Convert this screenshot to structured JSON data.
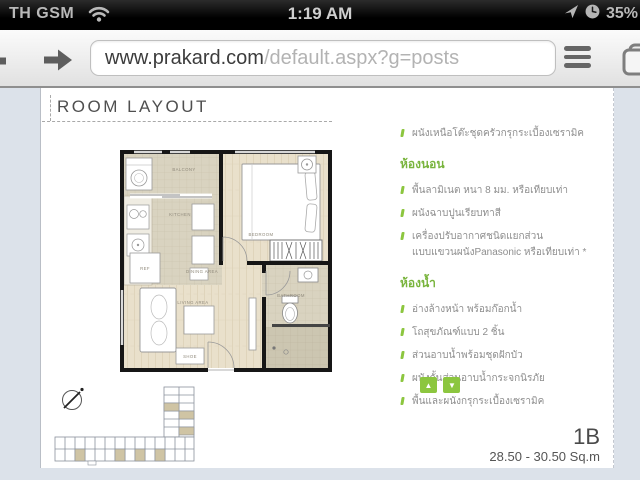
{
  "status_bar": {
    "carrier": "TH GSM",
    "time": "1:19 AM",
    "battery_percent": "35%"
  },
  "browser": {
    "url_host": "www.prakard.com",
    "url_path": "/default.aspx?g=posts"
  },
  "page": {
    "heading": "ROOM LAYOUT",
    "specs": {
      "intro_items": [
        "ผนังเหนือโต๊ะชุดครัวกรุกระเบื้องเซรามิค"
      ],
      "sections": [
        {
          "title": "ห้องนอน",
          "items": [
            "พื้นลามิเนต หนา 8 มม. หรือเทียบเท่า",
            "ผนังฉาบปูนเรียบทาสี",
            "เครื่องปรับอากาศชนิดแยกส่วน",
            "แบบแขวนผนังPanasonic หรือเทียบเท่า *"
          ]
        },
        {
          "title": "ห้องน้ำ",
          "items": [
            "อ่างล้างหน้า พร้อมก๊อกน้ำ",
            "โถสุขภัณฑ์แบบ 2 ชิ้น",
            "ส่วนอาบน้ำพร้อมชุดฝักบัว",
            "ผนังกั้นส่วนอาบน้ำกระจกนิรภัย",
            "พื้นและผนังกรุกระเบื้องเซรามิค"
          ]
        }
      ]
    },
    "nav": {
      "up_glyph": "▲",
      "down_glyph": "▼"
    },
    "unit": {
      "type": "1B",
      "area": "28.50 - 30.50 Sq.m"
    },
    "floor_plan": {
      "rooms": [
        "BALCONY",
        "KITCHEN",
        "DINING AREA",
        "REF",
        "LIVING AREA",
        "SHOE",
        "BEDROOM",
        "BATHROOM"
      ]
    },
    "colors": {
      "accent_green": "#8cc63f",
      "heading_green": "#79b43d",
      "page_background": "#dce2ea"
    }
  }
}
